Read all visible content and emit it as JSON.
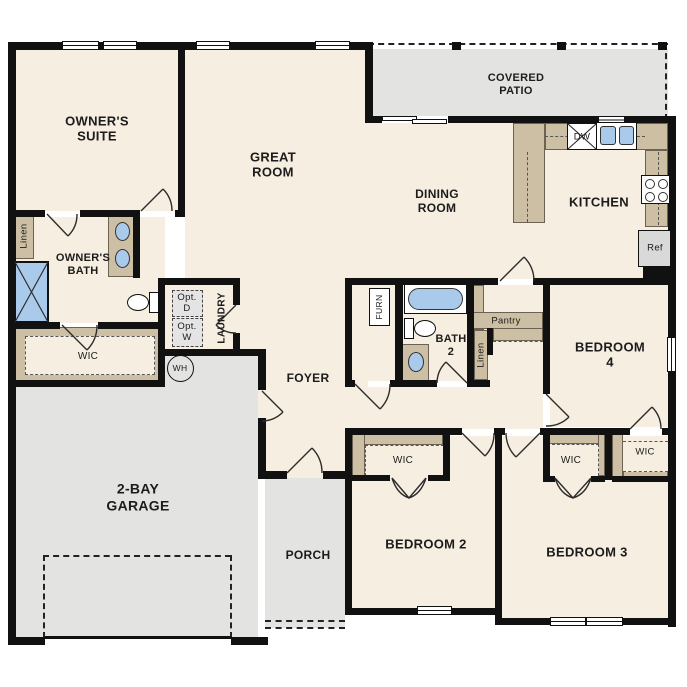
{
  "title": "Single-story residential floor plan",
  "labels": {
    "owners_suite": "OWNER'S\nSUITE",
    "great_room": "GREAT\nROOM",
    "covered_patio": "COVERED\nPATIO",
    "dining_room": "DINING\nROOM",
    "kitchen": "KITCHEN",
    "owners_bath": "OWNER'S\nBATH",
    "owners_wic": "WIC",
    "owners_linen": "Linen",
    "laundry": "LAUNDRY",
    "opt_dryer": "Opt.\nD",
    "opt_washer": "Opt.\nW",
    "water_heater": "WH",
    "foyer": "FOYER",
    "garage": "2-BAY\nGARAGE",
    "porch": "PORCH",
    "furnace": "FURN",
    "bath2": "BATH\n2",
    "pantry": "Pantry",
    "hall_linen": "Linen",
    "bedroom2": "BEDROOM 2",
    "bedroom3": "BEDROOM 3",
    "bedroom4": "BEDROOM 4",
    "bedroom2_wic": "WIC",
    "bedroom3_wic": "WIC",
    "bedroom4_wic": "WIC",
    "dishwasher": "DW",
    "refrigerator": "Ref"
  },
  "colors": {
    "floor": "#f6eee0",
    "outdoor": "#e3e3e1",
    "casework": "#ccbfa3",
    "fixture": "#aacaec",
    "wall": "#111111"
  }
}
